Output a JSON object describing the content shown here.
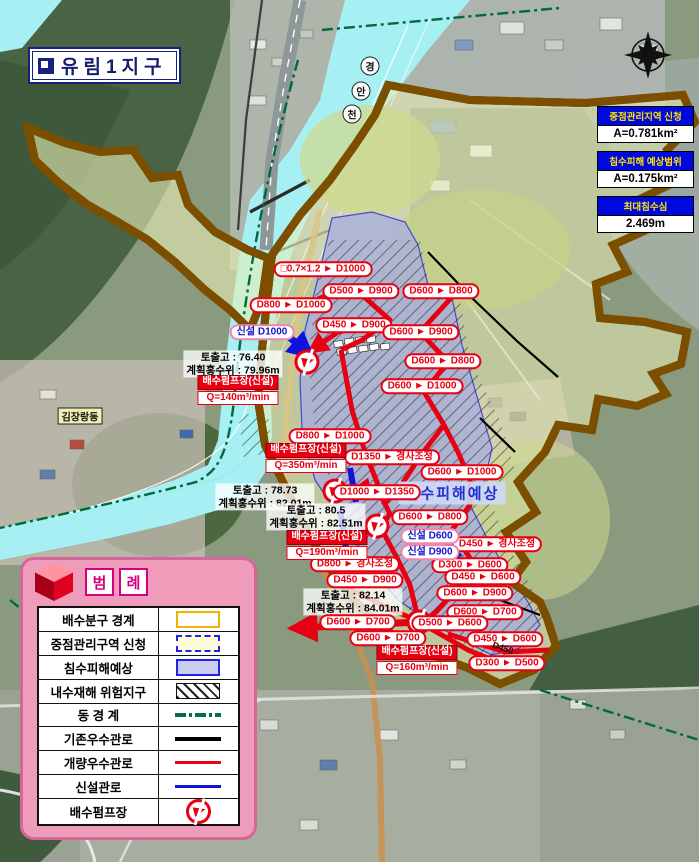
{
  "title": {
    "icon": "cube-icon",
    "text": "유림1지구"
  },
  "stats": [
    {
      "header": "중점관리지역 신청",
      "value": "A=0.781km²"
    },
    {
      "header": "침수피해 예상범위",
      "value": "A=0.175km²"
    },
    {
      "header": "최대침수심",
      "value": "2.469m"
    }
  ],
  "legend": {
    "title_chars": [
      "범",
      "례"
    ],
    "rows": [
      {
        "label": "배수분구 경계",
        "swatch": "boundary"
      },
      {
        "label": "중점관리구역 신청",
        "swatch": "district"
      },
      {
        "label": "침수피해예상",
        "swatch": "flood"
      },
      {
        "label": "내수재해 위험지구",
        "swatch": "hazard"
      },
      {
        "label": "동 경 계",
        "swatch": "dong"
      },
      {
        "label": "기존우수관로",
        "swatch": "black"
      },
      {
        "label": "개량우수관로",
        "swatch": "red"
      },
      {
        "label": "신설관로",
        "swatch": "blue"
      },
      {
        "label": "배수펌프장",
        "swatch": "pump"
      }
    ]
  },
  "map": {
    "flood_tag": {
      "text": "침수피해예상",
      "x": 452,
      "y": 493
    },
    "dong_tag": {
      "text": "김장랑동",
      "x": 80,
      "y": 416
    },
    "river_name_chars": [
      {
        "ch": "경",
        "x": 370,
        "y": 66
      },
      {
        "ch": "안",
        "x": 361,
        "y": 91
      },
      {
        "ch": "천",
        "x": 352,
        "y": 114
      }
    ],
    "pipe_annotation": {
      "text": "D450",
      "x": 503,
      "y": 648,
      "angle": 18
    },
    "pipe_labels": [
      {
        "text": "□0.7×1.2 ► D1000",
        "x": 323,
        "y": 269,
        "kind": "red"
      },
      {
        "text": "D500 ► D900",
        "x": 361,
        "y": 291,
        "kind": "red"
      },
      {
        "text": "D600 ► D800",
        "x": 441,
        "y": 291,
        "kind": "red"
      },
      {
        "text": "D800 ► D1000",
        "x": 291,
        "y": 305,
        "kind": "red"
      },
      {
        "text": "D450 ► D900",
        "x": 354,
        "y": 325,
        "kind": "red"
      },
      {
        "text": "D600 ► D900",
        "x": 421,
        "y": 332,
        "kind": "red"
      },
      {
        "text": "D600 ► D800",
        "x": 443,
        "y": 361,
        "kind": "red"
      },
      {
        "text": "D600 ► D1000",
        "x": 422,
        "y": 386,
        "kind": "red"
      },
      {
        "text": "D800 ► D1000",
        "x": 330,
        "y": 436,
        "kind": "red"
      },
      {
        "text": "D1350 ► 경사조정",
        "x": 392,
        "y": 457,
        "kind": "red"
      },
      {
        "text": "D600 ► D1000",
        "x": 462,
        "y": 472,
        "kind": "red"
      },
      {
        "text": "D1000 ► D1350",
        "x": 377,
        "y": 492,
        "kind": "red"
      },
      {
        "text": "D600 ► D800",
        "x": 430,
        "y": 517,
        "kind": "red"
      },
      {
        "text": "D450 ► 경사조정",
        "x": 497,
        "y": 544,
        "kind": "red"
      },
      {
        "text": "D800 ► 경사조정",
        "x": 355,
        "y": 564,
        "kind": "red"
      },
      {
        "text": "D300 ► D600",
        "x": 470,
        "y": 565,
        "kind": "red"
      },
      {
        "text": "D450 ► D600",
        "x": 483,
        "y": 577,
        "kind": "red"
      },
      {
        "text": "D450 ► D900",
        "x": 365,
        "y": 580,
        "kind": "red"
      },
      {
        "text": "D600 ► D900",
        "x": 475,
        "y": 593,
        "kind": "red"
      },
      {
        "text": "D600 ► D700",
        "x": 485,
        "y": 612,
        "kind": "red"
      },
      {
        "text": "D600 ► D700",
        "x": 358,
        "y": 622,
        "kind": "red"
      },
      {
        "text": "D500 ► D600",
        "x": 450,
        "y": 623,
        "kind": "red"
      },
      {
        "text": "D600 ► D700",
        "x": 388,
        "y": 638,
        "kind": "red"
      },
      {
        "text": "D450 ► D600",
        "x": 505,
        "y": 639,
        "kind": "red"
      },
      {
        "text": "D300 ► D500",
        "x": 507,
        "y": 663,
        "kind": "red"
      },
      {
        "text": "신설 D1000",
        "x": 262,
        "y": 332,
        "kind": "blue"
      },
      {
        "text": "신설 D600",
        "x": 430,
        "y": 536,
        "kind": "blue"
      },
      {
        "text": "신설 D900",
        "x": 430,
        "y": 552,
        "kind": "blue"
      }
    ],
    "pump_stations": [
      {
        "name": "배수펌프장(신설)",
        "q": "Q=140m³/min",
        "x": 238,
        "y": 390
      },
      {
        "name": "배수펌프장(신설)",
        "q": "Q=350m³/min",
        "x": 306,
        "y": 458
      },
      {
        "name": "배수펌프장(신설)",
        "q": "Q=190m³/min",
        "x": 327,
        "y": 545
      },
      {
        "name": "배수펌프장(신설)",
        "q": "Q=160m³/min",
        "x": 417,
        "y": 660
      }
    ],
    "pump_icons": [
      {
        "x": 307,
        "y": 362
      },
      {
        "x": 335,
        "y": 491
      },
      {
        "x": 377,
        "y": 526
      },
      {
        "x": 419,
        "y": 622
      }
    ],
    "level_notes": [
      {
        "line1": "토출고 : 76.40",
        "line2": "계획홍수위 : 79.96m",
        "x": 233,
        "y": 364
      },
      {
        "line1": "토출고 : 78.73",
        "line2": "계획홍수위 : 82.01m",
        "x": 265,
        "y": 497
      },
      {
        "line1": "토출고 : 80.5",
        "line2": "계획홍수위 : 82.51m",
        "x": 316,
        "y": 517
      },
      {
        "line1": "토출고 : 82.14",
        "line2": "계획홍수위 : 84.01m",
        "x": 353,
        "y": 602
      }
    ]
  },
  "colors": {
    "improved_pipe": "#e60012",
    "new_pipe": "#1111dd",
    "existing_pipe": "#000000",
    "boundary": "#f0ad00",
    "district_dash": "#2121e8",
    "flood_fill": "#c9cdf2",
    "legend_panel": "#ef9cba",
    "stat_header_bg": "#0009dd",
    "stat_header_text": "#ffe400"
  }
}
